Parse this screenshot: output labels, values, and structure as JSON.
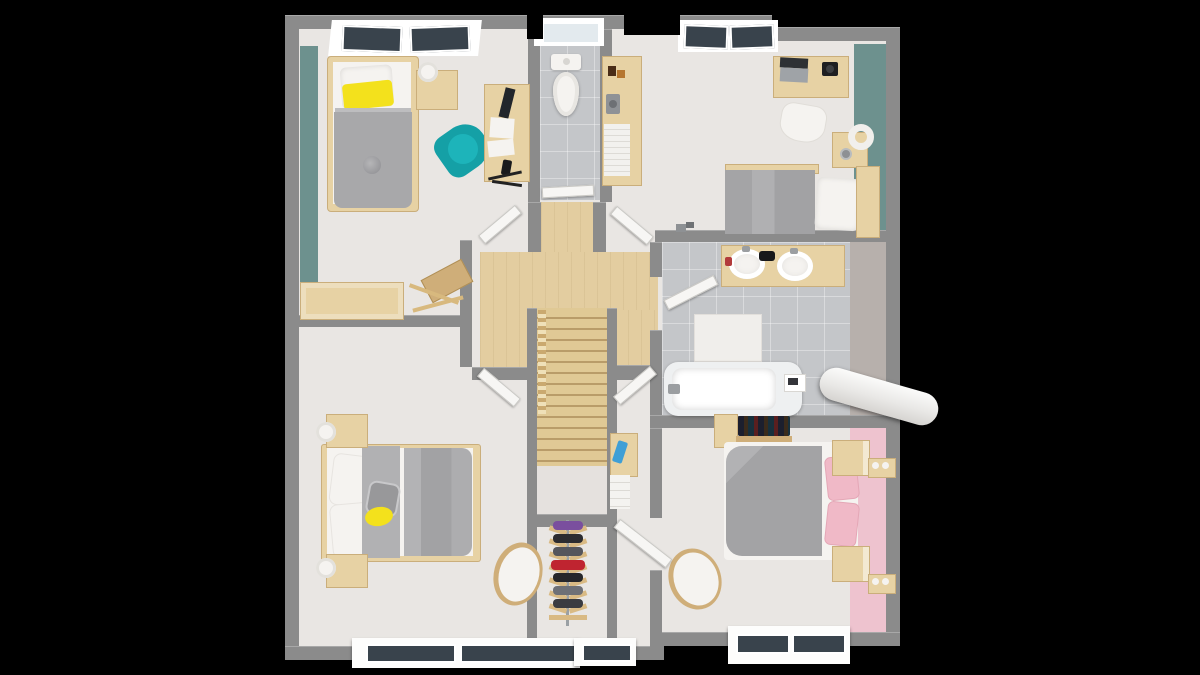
{
  "scene": {
    "type": "3d-floorplan-top-down-render",
    "storey": "upper floor with central staircase",
    "background": "#000000"
  },
  "palette": {
    "wall": "#8b8b8b",
    "floor": "#e9e6e3",
    "wood": "#e3cda0",
    "woodp": "#e7d2a4",
    "woodlight": "#eedfb5",
    "wooddark": "#cfae79",
    "stair": "#e0c995",
    "tile": "#c4c6c9",
    "teal": "#6d918e",
    "tealchair": "#15a0a6",
    "pink": "#eec3cf",
    "pinkpillow": "#f0b9c7",
    "yellow": "#f3e11c",
    "gray": "#a8a8aa",
    "white": "#f5f3f0",
    "glass": "#39434c",
    "door": "#f7f6f4",
    "red": "#bf2430",
    "landing": "#e5e1de",
    "bathface": "#b7b0ac"
  },
  "rooms": [
    {
      "id": "bedroom-top-left",
      "kind": "bedroom",
      "accent_wall": "teal",
      "windows_top": 2,
      "furniture": [
        "single bed with yellow pillow and gray duvet",
        "nightstand with white lamp",
        "teal armchair",
        "wooden desk with monitor and papers",
        "desk chair",
        "storage chest",
        "valet stand"
      ]
    },
    {
      "id": "wc",
      "kind": "toilet room",
      "windows_top": 1,
      "furniture": [
        "toilet"
      ]
    },
    {
      "id": "bedroom-top-right",
      "kind": "bedroom",
      "accent_wall": "teal",
      "windows_top": 2,
      "furniture": [
        "sideboard with books and camera",
        "desk with laptop and camera",
        "white chair",
        "nightstand with ring lamp and clock",
        "double bed with gray duvet"
      ]
    },
    {
      "id": "bathroom",
      "kind": "bathroom",
      "windows_top": 0,
      "furniture": [
        "double-sink vanity",
        "bath mat",
        "bathtub",
        "rolled white mattress sticking over the wall"
      ]
    },
    {
      "id": "bedroom-bottom-left",
      "kind": "bedroom",
      "windows_bottom": 2,
      "furniture": [
        "double bed with gray runner and yellow throw",
        "two nightstands with white lamps",
        "round shell chair"
      ]
    },
    {
      "id": "dressing-nook",
      "kind": "closet",
      "windows_bottom": 1,
      "furniture": [
        "shoe rack with colorful shoes",
        "small shelf with blue object and white boxes"
      ]
    },
    {
      "id": "bedroom-bottom-right",
      "kind": "bedroom",
      "accent_wall": "pink",
      "windows_bottom": 2,
      "furniture": [
        "double bed with pink pillows",
        "two nightstands",
        "wall book shelf",
        "two candle shelves",
        "white shell chair"
      ]
    }
  ],
  "hallway": {
    "floor": "light oak",
    "features": [
      "cross-shaped landing",
      "staircase going down",
      "wood railing"
    ],
    "open_doors": 7
  }
}
